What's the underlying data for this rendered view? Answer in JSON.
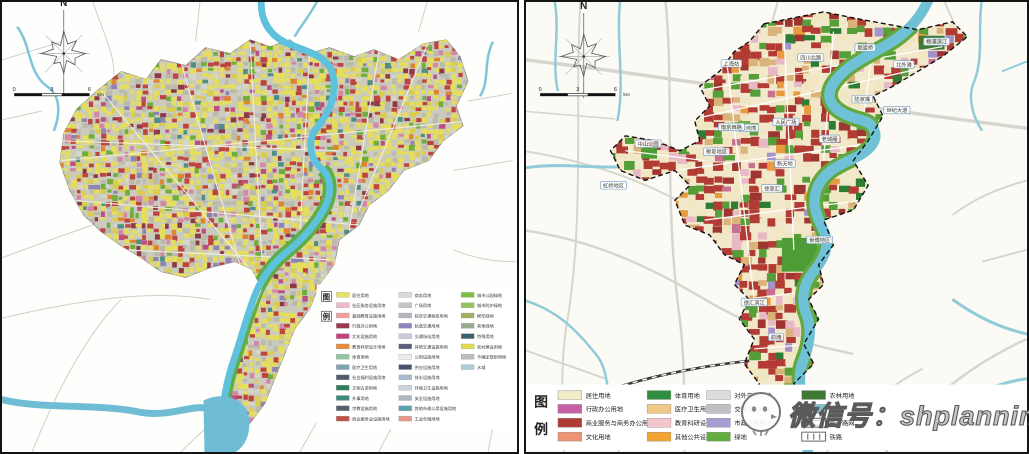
{
  "watermark": {
    "text": "微信号：shplanning",
    "logo": "wechat-bubble-logo"
  },
  "left_map": {
    "kind": "detailed current land-use map",
    "north_label": "N",
    "scale_ticks": [
      "0",
      "3",
      "6"
    ],
    "scale_unit": "km",
    "legend_title": [
      "图",
      "例"
    ],
    "legend_columns": [
      [
        {
          "label": "居住用地",
          "color": "#E8E163"
        },
        {
          "label": "社区服务设施用地",
          "color": "#EFB9C9"
        },
        {
          "label": "基础教育设施用地",
          "color": "#F39E9B"
        },
        {
          "label": "行政办公用地",
          "color": "#9E3A4E"
        },
        {
          "label": "文化设施用地",
          "color": "#C2417E"
        },
        {
          "label": "教育科研设计用地",
          "color": "#E98A3C"
        },
        {
          "label": "体育用地",
          "color": "#8FC6A5"
        },
        {
          "label": "医疗卫生用地",
          "color": "#7FA3B5"
        },
        {
          "label": "社会福利设施用地",
          "color": "#4E5D6E"
        },
        {
          "label": "文物古迹用地",
          "color": "#2E7D5B"
        },
        {
          "label": "外事用地",
          "color": "#3E8A7D"
        },
        {
          "label": "宗教设施用地",
          "color": "#555F6B"
        },
        {
          "label": "商业服务业设施用地",
          "color": "#C05048"
        }
      ],
      [
        {
          "label": "商务用地",
          "color": "#D9D9DB"
        },
        {
          "label": "广场用地",
          "color": "#C3C3C9"
        },
        {
          "label": "综合交通枢纽用地",
          "color": "#B5B6BF"
        },
        {
          "label": "轨道交通用地",
          "color": "#9184BC"
        },
        {
          "label": "交通场站用地",
          "color": "#CCC6DE"
        },
        {
          "label": "其他交通设施用地",
          "color": "#5C5C7E"
        },
        {
          "label": "公用设施用地",
          "color": "#EDEDEF"
        },
        {
          "label": "供应设施用地",
          "color": "#46526B"
        },
        {
          "label": "排水设施用地",
          "color": "#A9BACB"
        },
        {
          "label": "环境卫生设施用地",
          "color": "#C9D3DB"
        },
        {
          "label": "安全设施用地",
          "color": "#AEB6C0"
        },
        {
          "label": "其他市政公用设施用地",
          "color": "#5BA2AC"
        },
        {
          "label": "工业仓储用地",
          "color": "#E59A8B"
        }
      ],
      [
        {
          "label": "城市公园绿地",
          "color": "#7FBF3F"
        },
        {
          "label": "城市防护绿地",
          "color": "#93C45C"
        },
        {
          "label": "楔形绿地",
          "color": "#A3AD62"
        },
        {
          "label": "其他绿地",
          "color": "#9AA98F"
        },
        {
          "label": "特殊用地",
          "color": "#39606E"
        },
        {
          "label": "农村建设用地",
          "color": "#E3DB4E"
        },
        {
          "label": "不确定规划用地",
          "color": "#BBBEBB"
        },
        {
          "label": "水域",
          "color": "#A9CEDC"
        }
      ]
    ],
    "mosaic_palette": [
      {
        "c": "#E5DE5C",
        "w": 40
      },
      {
        "c": "#D9CD4E",
        "w": 7
      },
      {
        "c": "#BE4440",
        "w": 12
      },
      {
        "c": "#8F3948",
        "w": 4
      },
      {
        "c": "#D486A6",
        "w": 4
      },
      {
        "c": "#BC4E86",
        "w": 3
      },
      {
        "c": "#B9B9AE",
        "w": 13
      },
      {
        "c": "#D5D5CA",
        "w": 5
      },
      {
        "c": "#6FAE3B",
        "w": 5
      },
      {
        "c": "#DF8433",
        "w": 3
      },
      {
        "c": "#8F83B5",
        "w": 2
      },
      {
        "c": "#4F8E85",
        "w": 2
      }
    ]
  },
  "right_map": {
    "kind": "planned land-use structure map with dashed city boundary",
    "north_label": "N",
    "scale_ticks": [
      "0",
      "3",
      "6"
    ],
    "scale_unit": "km",
    "legend_title": [
      "图",
      "例"
    ],
    "legend_columns": [
      [
        {
          "label": "居住用地",
          "color": "#F2EBC8"
        },
        {
          "label": "行政办公用地",
          "color": "#C75FA8"
        },
        {
          "label": "商业服务与商务办公用地",
          "color": "#B03B34"
        },
        {
          "label": "文化用地",
          "color": "#EF9377"
        }
      ],
      [
        {
          "label": "体育用地",
          "color": "#2F8F3F"
        },
        {
          "label": "医疗卫生用地",
          "color": "#F0C887"
        },
        {
          "label": "教育科研设计用地",
          "color": "#F4C7CF"
        },
        {
          "label": "其他公共设施用地",
          "color": "#F2A432"
        }
      ],
      [
        {
          "label": "对外交通用地",
          "color": "#DCDCDE"
        },
        {
          "label": "交通场站用地",
          "color": "#BFBFC5"
        },
        {
          "label": "市政设施用地",
          "color": "#A79BD1"
        },
        {
          "label": "绿地",
          "color": "#61AE3C"
        }
      ],
      [
        {
          "label": "农林用地",
          "color": "#3F7A35"
        },
        {
          "label": "水域",
          "color": "#7CC0CE"
        },
        {
          "label": "骨干路网",
          "symbol": "road"
        },
        {
          "label": "铁路",
          "symbol": "rail"
        }
      ]
    ],
    "place_labels": [
      {
        "text": "上海站",
        "x": 207,
        "y": 62
      },
      {
        "text": "四川北路",
        "x": 287,
        "y": 56
      },
      {
        "text": "提篮桥",
        "x": 342,
        "y": 46
      },
      {
        "text": "杨浦滨江",
        "x": 414,
        "y": 40
      },
      {
        "text": "北外滩",
        "x": 381,
        "y": 63
      },
      {
        "text": "苏河湾",
        "x": 224,
        "y": 127
      },
      {
        "text": "陆家嘴",
        "x": 339,
        "y": 98
      },
      {
        "text": "世纪大道",
        "x": 374,
        "y": 109
      },
      {
        "text": "南京西路",
        "x": 207,
        "y": 126
      },
      {
        "text": "人民广场",
        "x": 262,
        "y": 121
      },
      {
        "text": "老城厢",
        "x": 306,
        "y": 138
      },
      {
        "text": "衡复地区",
        "x": 192,
        "y": 151
      },
      {
        "text": "新天地",
        "x": 261,
        "y": 163
      },
      {
        "text": "徐家汇",
        "x": 248,
        "y": 188
      },
      {
        "text": "中山公园",
        "x": 123,
        "y": 143
      },
      {
        "text": "虹桥地区",
        "x": 88,
        "y": 185
      },
      {
        "text": "世博地区",
        "x": 296,
        "y": 240
      },
      {
        "text": "徐汇滨江",
        "x": 230,
        "y": 303
      },
      {
        "text": "前滩",
        "x": 252,
        "y": 338
      },
      {
        "text": "吴泾",
        "x": 250,
        "y": 400
      }
    ],
    "parcel_palette": [
      {
        "c": "",
        "w": 30
      },
      {
        "c": "#B23B33",
        "w": 22
      },
      {
        "c": "#9E3530",
        "w": 5
      },
      {
        "c": "#569E38",
        "w": 9
      },
      {
        "c": "#2F7D33",
        "w": 3
      },
      {
        "c": "#D9B37A",
        "w": 5
      },
      {
        "c": "#E7B9C4",
        "w": 5
      },
      {
        "c": "#E89A3E",
        "w": 3
      },
      {
        "c": "#A393C9",
        "w": 2
      },
      {
        "c": "#C9708F",
        "w": 2
      },
      {
        "c": "#F0E7C2",
        "w": 14
      }
    ]
  }
}
